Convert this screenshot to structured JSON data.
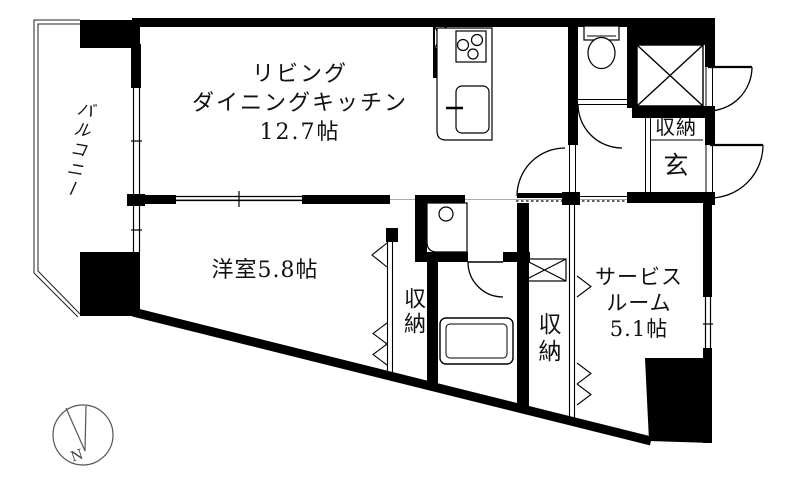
{
  "floorplan": {
    "balcony": {
      "label": "バルコニー"
    },
    "ldk": {
      "line1": "リビング",
      "line2": "ダイニングキッチン",
      "line3": "12.7帖"
    },
    "western_room": {
      "label": "洋室5.8帖"
    },
    "service_room": {
      "line1": "サービス",
      "line2": "ルーム",
      "line3": "5.1帖"
    },
    "entrance_storage": {
      "label": "収納"
    },
    "entrance": {
      "label": "玄"
    },
    "hall_storage": {
      "label": "収納"
    },
    "bedroom_storage": {
      "label": "収納"
    },
    "compass": {
      "north_label": "N"
    }
  },
  "colors": {
    "wall": "#000000",
    "line": "#000000",
    "guide": "#aaaaaa",
    "background": "#ffffff"
  }
}
